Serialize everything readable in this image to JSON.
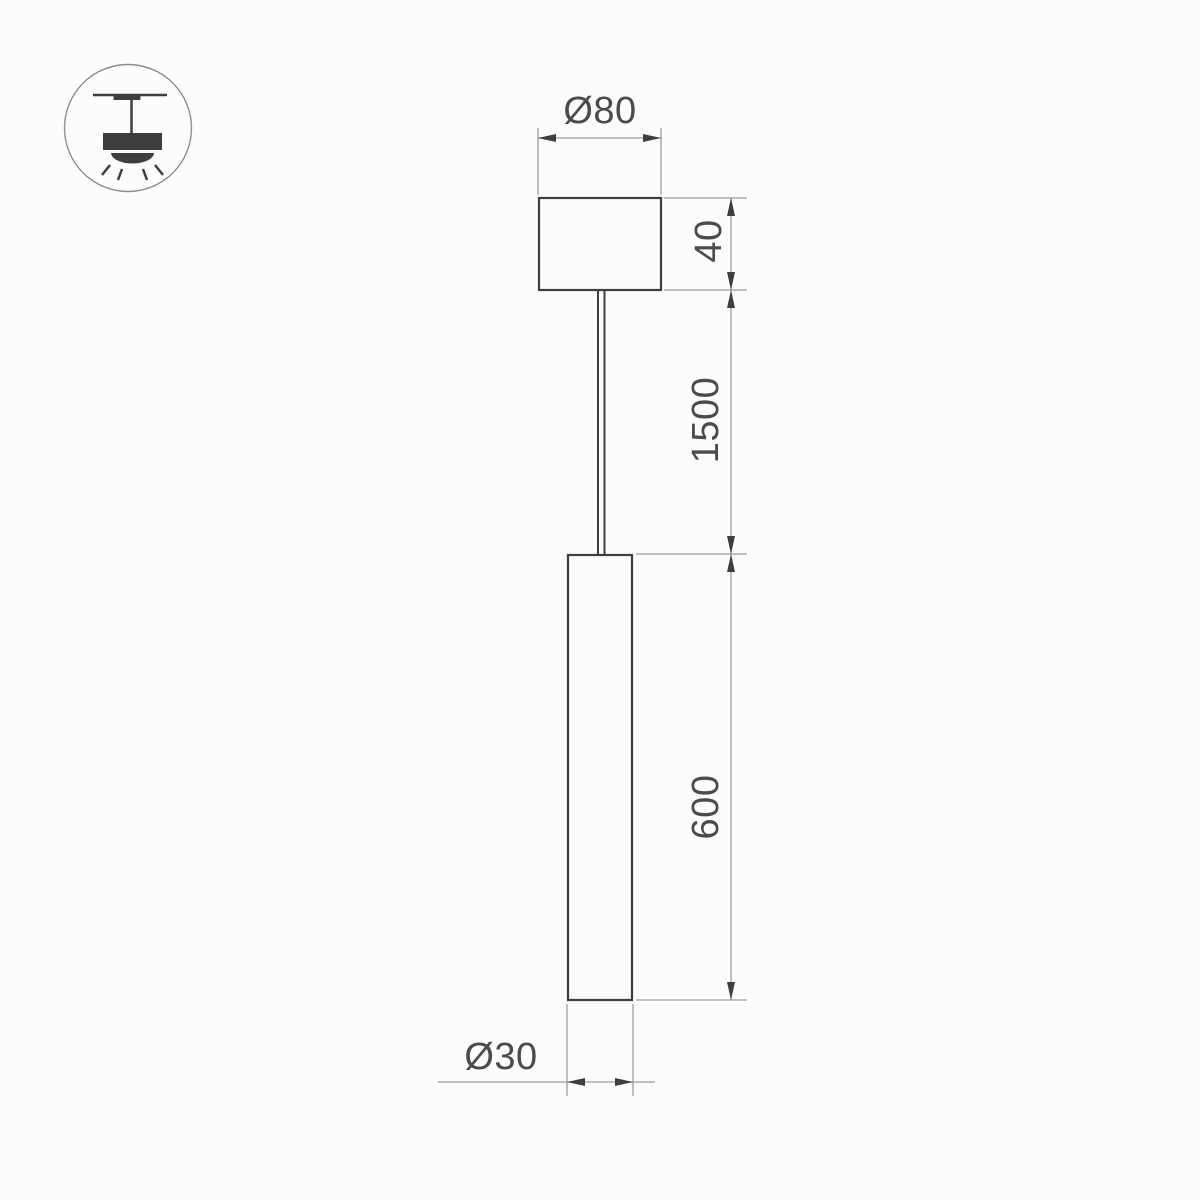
{
  "colors": {
    "background": "#fcfcfc",
    "object_line": "#3e3e3e",
    "dimension_line": "#9c9c9c",
    "arrow": "#3e3e3e",
    "text": "#4b4b4b",
    "icon": "#3e3e3e",
    "icon_circle": "#8f8f8f"
  },
  "icon": {
    "name": "ceiling-pendant-lamp-icon"
  },
  "dimensions": {
    "canopy_diameter": "Ø80",
    "canopy_height": "40",
    "suspension_length": "1500",
    "tube_length": "600",
    "tube_diameter": "Ø30"
  }
}
